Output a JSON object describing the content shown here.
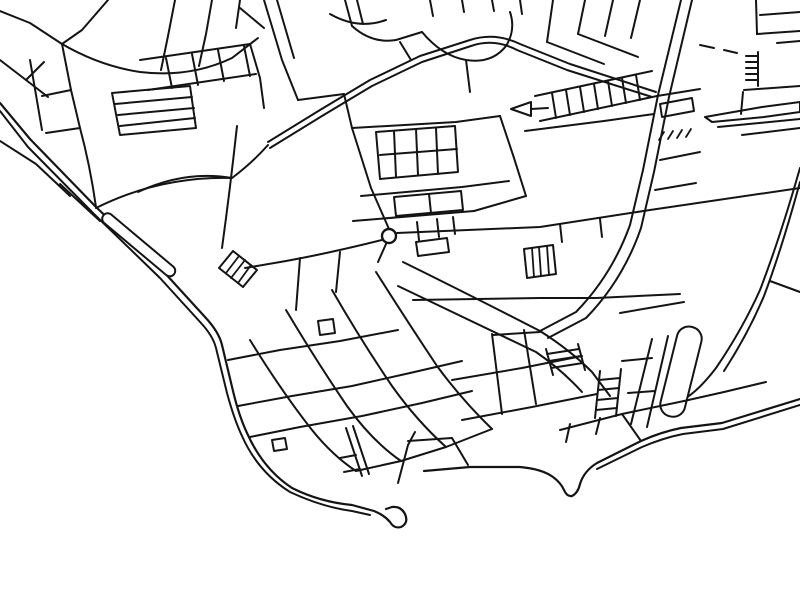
{
  "map": {
    "kind": "monochrome-street-map-line-art",
    "background_color": "#ffffff",
    "line_color": "#141414",
    "stroke_width": 2,
    "canvas": {
      "width": 800,
      "height": 600
    },
    "landmarks": {
      "roundabout": {
        "cx": 389,
        "cy": 236,
        "r": 7
      },
      "breakwater_hook_tip": {
        "x": 398,
        "y": 517
      },
      "sea_region": "lower-left"
    },
    "layers": [
      {
        "name": "coastline",
        "shapes": [
          {
            "n": "promenade-outer-line",
            "sw": 2.2,
            "d": "M 0,103 L 30,139 L 96,207 L 163,271 L 205,317 Q 219,332 222,345 L 233,391 Q 239,416 247,433 Q 263,469 292,488 Q 320,502 352,505 L 374,511 Q 384,515 390,522 Q 394,529 401,527 Q 409,523 405,514 Q 401,506 392,507 L 386,509"
          },
          {
            "n": "promenade-inner-line",
            "sw": 2,
            "d": "M 0,111 L 28,147 L 94,214 L 160,278 L 201,323 Q 213,336 216,348 L 227,393 Q 234,419 242,436 Q 258,472 290,492 Q 322,507 352,511 L 370,515"
          },
          {
            "n": "esplanade-line",
            "d": "M 0,141 L 36,164 L 70,196"
          },
          {
            "n": "coast-notch",
            "d": "M 60,184 L 88,210 L 100,221"
          },
          {
            "n": "south-coast-line",
            "sw": 2.2,
            "d": "M 424,471 L 470,467 L 520,467 Q 542,469 553,477 Q 561,483 564,490 Q 567,497 572,496 Q 578,493 580,484 Q 584,471 597,463 L 641,441 Q 661,432 681,428 L 722,423 L 800,399"
          },
          {
            "n": "south-coast-inner-line",
            "d": "M 597,469 L 642,447 Q 663,438 683,434 L 723,429 L 800,405"
          },
          {
            "n": "harbour-street",
            "d": "M 398,483 L 408,445 L 415,432"
          },
          {
            "n": "right-coast-road-a",
            "d": "M 800,168 Q 780,238 760,290 Q 742,330 716,368 Q 700,389 686,398"
          },
          {
            "n": "right-coast-road-b",
            "d": "M 800,182 Q 782,248 764,296 Q 748,334 724,371"
          }
        ]
      },
      {
        "name": "piers",
        "shapes": [
          {
            "n": "stone-pier",
            "w": 92,
            "h": 11,
            "rx": 5.5,
            "tf": "translate(107,211) rotate(40)",
            "f": "#ffffff"
          },
          {
            "n": "harbour-pier",
            "w": 25,
            "h": 92,
            "rx": 12,
            "tf": "translate(680,324) rotate(14)",
            "f": "#ffffff"
          },
          {
            "n": "hatched-building-outline",
            "d": "M 233,251 L 257,270 L 243,287 L 219,268 Z",
            "f": "#ffffff"
          },
          {
            "n": "hatched-building-stripes",
            "sw": 1.8,
            "d": "M 239,256 L 226,273 M 245,260 L 231,278 M 251,265 L 238,283"
          }
        ]
      },
      {
        "name": "major-roads",
        "shapes": [
          {
            "n": "boulevard-line-a",
            "d": "M 268,142 L 320,110 L 370,80 L 420,56 L 470,40 Q 495,32 520,44 L 570,64 L 656,92"
          },
          {
            "n": "boulevard-line-b",
            "d": "M 270,148 L 322,116 L 372,86 L 422,62 L 471,46 Q 494,38 517,50 L 567,70 L 652,97"
          },
          {
            "n": "highway-line-a",
            "d": "M 681,0 L 658,95 L 643,170 L 630,225 Q 612,275 576,312 L 540,331"
          },
          {
            "n": "highway-line-b",
            "d": "M 692,0 L 669,97 L 654,172 L 641,228 Q 623,280 586,318 L 548,338"
          },
          {
            "n": "avenue-se-line-a",
            "d": "M 403,262 Q 470,295 540,331 Q 570,350 592,372 L 610,396"
          },
          {
            "n": "avenue-se-line-b",
            "d": "M 398,286 Q 465,318 536,352 Q 562,370 582,392"
          },
          {
            "n": "east-road",
            "d": "M 397,233 L 540,227 L 650,210 L 800,188"
          },
          {
            "n": "west-road",
            "d": "M 382,240 Q 330,253 286,261 L 245,268"
          },
          {
            "n": "roundabout-stub",
            "d": "M 386,244 L 378,262"
          },
          {
            "n": "coast-link-road",
            "d": "M 96,208 Q 160,176 232,178 Q 252,163 268,145"
          }
        ]
      },
      {
        "name": "roundabout",
        "shapes": [
          {
            "n": "roundabout-circle",
            "cx": 389,
            "cy": 236,
            "r": 7,
            "f": "#ffffff",
            "sw": 2.4
          }
        ]
      },
      {
        "name": "northwest-streets",
        "shapes": [
          {
            "n": "street",
            "d": "M 108,0 L 82,30 L 62,44"
          },
          {
            "n": "street",
            "d": "M 0,11 L 30,23 L 62,44"
          },
          {
            "n": "street",
            "d": "M 62,44 Q 100,66 140,72 Q 190,78 232,58 L 258,38"
          },
          {
            "n": "street",
            "d": "M 175,0 L 168,36 L 161,70"
          },
          {
            "n": "street",
            "d": "M 212,0 L 206,34 L 199,66"
          },
          {
            "n": "street",
            "d": "M 240,0 L 236,28"
          },
          {
            "n": "street",
            "d": "M 0,60 L 26,80 L 48,97"
          },
          {
            "n": "street",
            "d": "M 26,80 L 44,62"
          },
          {
            "n": "street",
            "d": "M 62,44 L 71,90 L 80,128"
          },
          {
            "n": "street",
            "d": "M 42,96 L 71,90"
          },
          {
            "n": "street",
            "d": "M 46,133 L 80,128"
          },
          {
            "n": "street",
            "d": "M 30,60 L 36,95 L 42,130"
          },
          {
            "n": "terrace-block-outline",
            "d": "M 112,93 L 190,86 L 196,128 L 120,135 Z"
          },
          {
            "n": "terrace-row",
            "d": "M 115,104 L 192,97 M 118,115 L 194,108 M 120,126 L 195,118"
          },
          {
            "n": "street",
            "d": "M 140,60 L 250,44"
          },
          {
            "n": "street",
            "d": "M 148,90 L 256,74"
          },
          {
            "n": "block-divider",
            "d": "M 166,58 L 172,88 M 192,54 L 198,85 M 218,50 L 224,81 M 244,46 L 250,76"
          },
          {
            "n": "street",
            "d": "M 250,44 L 260,78 L 264,108"
          },
          {
            "n": "street",
            "d": "M 237,126 Q 230,190 222,248"
          },
          {
            "n": "street",
            "d": "M 80,128 Q 90,165 96,207"
          },
          {
            "n": "street",
            "d": "M 138,192 Q 185,170 232,178"
          }
        ]
      },
      {
        "name": "north-streets",
        "shapes": [
          {
            "n": "street",
            "d": "M 264,0 L 282,60 L 298,100"
          },
          {
            "n": "street",
            "d": "M 277,0 L 294,58"
          },
          {
            "n": "street",
            "d": "M 240,8 L 264,28"
          },
          {
            "n": "street",
            "d": "M 345,0 L 352,26 M 357,0 L 363,24"
          },
          {
            "n": "street",
            "d": "M 298,100 L 344,94"
          },
          {
            "n": "street",
            "d": "M 344,94 L 352,128"
          },
          {
            "n": "street",
            "d": "M 330,14 Q 358,30 386,20"
          },
          {
            "n": "street",
            "d": "M 352,26 Q 372,44 396,40 L 422,32"
          },
          {
            "n": "street",
            "d": "M 422,32 Q 442,56 466,60 Q 492,64 506,46 Q 516,30 510,12"
          },
          {
            "n": "street",
            "d": "M 466,60 L 470,92"
          },
          {
            "n": "street-stubs",
            "d": "M 430,0 L 433,16 M 462,0 L 464,12 M 492,0 L 494,11 M 520,0 L 522,14"
          },
          {
            "n": "street",
            "d": "M 400,42 L 411,60"
          }
        ]
      },
      {
        "name": "north-blocks",
        "shapes": [
          {
            "n": "street",
            "d": "M 352,128 L 456,122 L 500,116"
          },
          {
            "n": "street",
            "d": "M 352,128 L 371,188 L 389,229"
          },
          {
            "n": "building-block-outline",
            "d": "M 376,132 L 455,126 L 458,172 L 380,179 Z"
          },
          {
            "n": "building-divider",
            "d": "M 394,131 L 396,177 M 416,129 L 418,175 M 436,128 L 438,174"
          },
          {
            "n": "building-divider",
            "d": "M 380,155 L 457,149"
          },
          {
            "n": "street",
            "d": "M 361,196 L 462,187 L 509,181"
          },
          {
            "n": "building-block-outline",
            "d": "M 394,197 L 461,191 L 463,210 L 396,216 Z"
          },
          {
            "n": "building-divider",
            "d": "M 429,194 L 431,213"
          },
          {
            "n": "street",
            "d": "M 353,221 L 474,211"
          },
          {
            "n": "street",
            "d": "M 500,116 L 514,158 L 526,196"
          },
          {
            "n": "street",
            "d": "M 526,196 L 474,211"
          }
        ]
      },
      {
        "name": "northeast-streets",
        "shapes": [
          {
            "n": "street-stubs",
            "d": "M 553,0 L 547,42 M 585,0 L 578,34 M 613,0 L 605,36 M 640,0 L 631,38"
          },
          {
            "n": "street",
            "d": "M 547,42 L 604,64"
          },
          {
            "n": "street",
            "d": "M 578,34 L 638,57"
          },
          {
            "n": "terrace-street-upper",
            "d": "M 535,96 L 652,71"
          },
          {
            "n": "terrace-street-lower",
            "d": "M 540,121 L 657,96"
          },
          {
            "n": "terrace-teeth",
            "d": "M 552,93 L 556,118 M 566,90 L 570,115 M 580,87 L 584,112 M 594,84 L 598,109 M 608,81 L 612,106 M 622,78 L 626,103 M 636,75 L 640,100"
          },
          {
            "n": "street",
            "d": "M 657,96 L 700,89"
          },
          {
            "n": "building-outline",
            "d": "M 660,104 L 692,98 L 694,111 L 662,117 Z"
          },
          {
            "n": "street",
            "d": "M 525,131 L 604,121 L 654,114"
          },
          {
            "n": "wedge-building",
            "d": "M 531,102 L 511,109 L 531,116 Z"
          },
          {
            "n": "street",
            "d": "M 531,109 L 548,108"
          },
          {
            "n": "street-dashes",
            "d": "M 700,45 L 714,48 M 724,50 L 737,53"
          },
          {
            "n": "street",
            "d": "M 756,0 L 757,34"
          },
          {
            "n": "street",
            "d": "M 757,34 L 800,31"
          },
          {
            "n": "street",
            "d": "M 760,15 L 800,12"
          },
          {
            "n": "terrace-comb",
            "d": "M 758,52 L 758,86 M 746,56 L 758,56 M 746,62 L 758,62 M 746,68 L 758,68 M 746,74 L 758,74 M 746,80 L 758,80"
          },
          {
            "n": "street",
            "d": "M 744,90 L 800,86"
          },
          {
            "n": "street",
            "d": "M 743,92 L 741,114"
          },
          {
            "n": "jetty-spit-outline",
            "d": "M 705,117 L 762,107 L 800,102 L 800,112 L 764,117 L 712,122 Z"
          },
          {
            "n": "street",
            "d": "M 718,127 L 800,119"
          },
          {
            "n": "street",
            "d": "M 742,135 L 800,128"
          },
          {
            "n": "slope-hatch-ticks",
            "sw": 1.8,
            "d": "M 664,132 L 659,140 M 673,131 L 668,139 M 682,130 L 677,138 M 691,129 L 686,137"
          },
          {
            "n": "street",
            "d": "M 777,43 L 800,41"
          },
          {
            "n": "street",
            "d": "M 660,160 L 700,152 M 655,190 L 696,183"
          }
        ]
      },
      {
        "name": "east-streets",
        "shapes": [
          {
            "n": "street",
            "d": "M 413,300 L 540,298 L 596,298 L 680,294"
          },
          {
            "n": "street-ticks",
            "d": "M 560,224 L 562,242 M 600,219 L 602,237"
          },
          {
            "n": "street-ticks",
            "d": "M 417,222 L 419,240 M 437,219 L 439,237 M 453,217 L 455,234"
          },
          {
            "n": "building-outline",
            "d": "M 416,242 L 447,238 L 449,252 L 418,256 Z"
          },
          {
            "n": "hatched-building-outline",
            "d": "M 524,249 L 553,245 L 556,274 L 527,278 Z"
          },
          {
            "n": "hatched-building-stripes",
            "sw": 1.8,
            "d": "M 532,248 L 534,277 M 539,247 L 541,276 M 547,246 L 549,275"
          }
        ]
      },
      {
        "name": "old-town",
        "shapes": [
          {
            "n": "street",
            "d": "M 228,360 L 280,350 L 340,341 L 398,330"
          },
          {
            "n": "street",
            "d": "M 238,406 L 292,396 L 352,386 L 410,373 L 462,361"
          },
          {
            "n": "street",
            "d": "M 250,437 L 300,427 L 362,416 L 422,403 L 472,391"
          },
          {
            "n": "street",
            "d": "M 250,340 Q 282,392 312,430 Q 333,456 356,471"
          },
          {
            "n": "street",
            "d": "M 286,310 Q 317,362 347,406 Q 372,441 401,461"
          },
          {
            "n": "street",
            "d": "M 332,290 Q 362,342 392,386 Q 417,421 446,447"
          },
          {
            "n": "street",
            "d": "M 376,272 Q 407,321 437,366 Q 462,400 492,429"
          },
          {
            "n": "street",
            "d": "M 300,258 L 296,310 M 340,252 L 336,292"
          },
          {
            "n": "building-outline",
            "d": "M 318,321 L 333,319 L 335,333 L 320,335 Z"
          },
          {
            "n": "building-outline",
            "d": "M 272,440 L 285,438 L 287,449 L 274,451 Z"
          },
          {
            "n": "street",
            "d": "M 356,471 L 401,461 M 401,461 L 446,447 M 446,447 L 492,429"
          },
          {
            "n": "street",
            "d": "M 408,441 L 452,438 M 452,438 L 468,465"
          },
          {
            "n": "street",
            "d": "M 452,380 L 522,368 L 582,356"
          },
          {
            "n": "street",
            "d": "M 462,420 L 532,407 L 597,394"
          },
          {
            "n": "street",
            "d": "M 492,334 L 502,414"
          },
          {
            "n": "street",
            "d": "M 524,330 L 536,404"
          },
          {
            "n": "terrace-ladder",
            "d": "M 546,349 L 553,375 M 578,344 L 585,370 M 547,354 L 579,349 M 549,361 L 581,356 M 551,368 L 583,363"
          },
          {
            "n": "terrace-ladder",
            "d": "M 600,371 L 595,418 M 621,369 L 616,416 M 599,380 L 620,378 M 598,390 L 619,388 M 597,400 L 618,398 M 596,410 L 617,408"
          },
          {
            "n": "street",
            "d": "M 540,332 L 493,335"
          },
          {
            "n": "bridge-street",
            "d": "M 346,428 L 362,476 M 353,426 L 369,474"
          },
          {
            "n": "street-ticks",
            "d": "M 340,458 L 356,455 M 344,472 L 360,469"
          }
        ]
      },
      {
        "name": "southeast-streets",
        "shapes": [
          {
            "n": "street",
            "d": "M 560,430 L 622,414 L 684,401"
          },
          {
            "n": "street",
            "d": "M 622,414 L 641,441"
          },
          {
            "n": "street",
            "d": "M 620,313 L 684,302"
          },
          {
            "n": "street",
            "d": "M 652,339 L 631,424"
          },
          {
            "n": "street",
            "d": "M 668,336 L 647,427"
          },
          {
            "n": "street",
            "d": "M 622,361 L 652,358 M 628,393 L 655,391"
          },
          {
            "n": "street",
            "d": "M 684,401 L 724,392 L 766,382"
          },
          {
            "n": "street",
            "d": "M 770,281 L 800,292"
          },
          {
            "n": "street-ticks",
            "d": "M 566,442 L 570,424 M 596,434 L 600,418"
          }
        ]
      }
    ]
  }
}
